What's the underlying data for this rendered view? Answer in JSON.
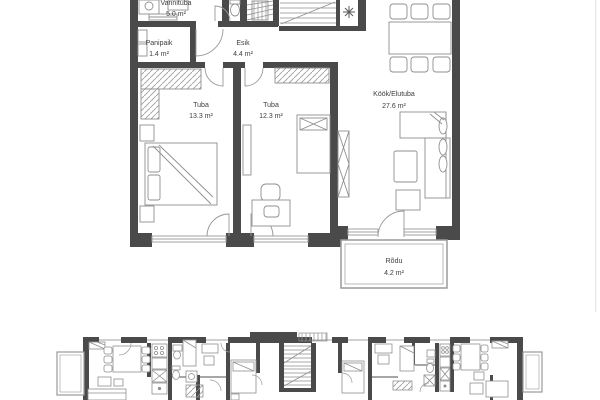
{
  "floor_plan": {
    "rooms": {
      "vannituba": {
        "name": "Vannituba",
        "area": "5.0 m²"
      },
      "panipaik": {
        "name": "Panipaik",
        "area": "1.4 m²"
      },
      "esik": {
        "name": "Esik",
        "area": "4.4 m²"
      },
      "tuba_13": {
        "name": "Tuba",
        "area": "13.3 m²"
      },
      "tuba_12": {
        "name": "Tuba",
        "area": "12.3 m²"
      },
      "kook_elutuba": {
        "name": "Köök/Elutuba",
        "area": "27.6 m²"
      },
      "rodu": {
        "name": "Rõdu",
        "area": "4.2 m²"
      }
    },
    "icons": {
      "snowflake": "snowflake-ventilation-symbol"
    },
    "colors": {
      "wall": "#4a4a4a",
      "furniture_line": "#8f8f8f",
      "window_line": "#a0a0a0",
      "label_text": "#3d3d3d",
      "background": "#ffffff"
    }
  }
}
